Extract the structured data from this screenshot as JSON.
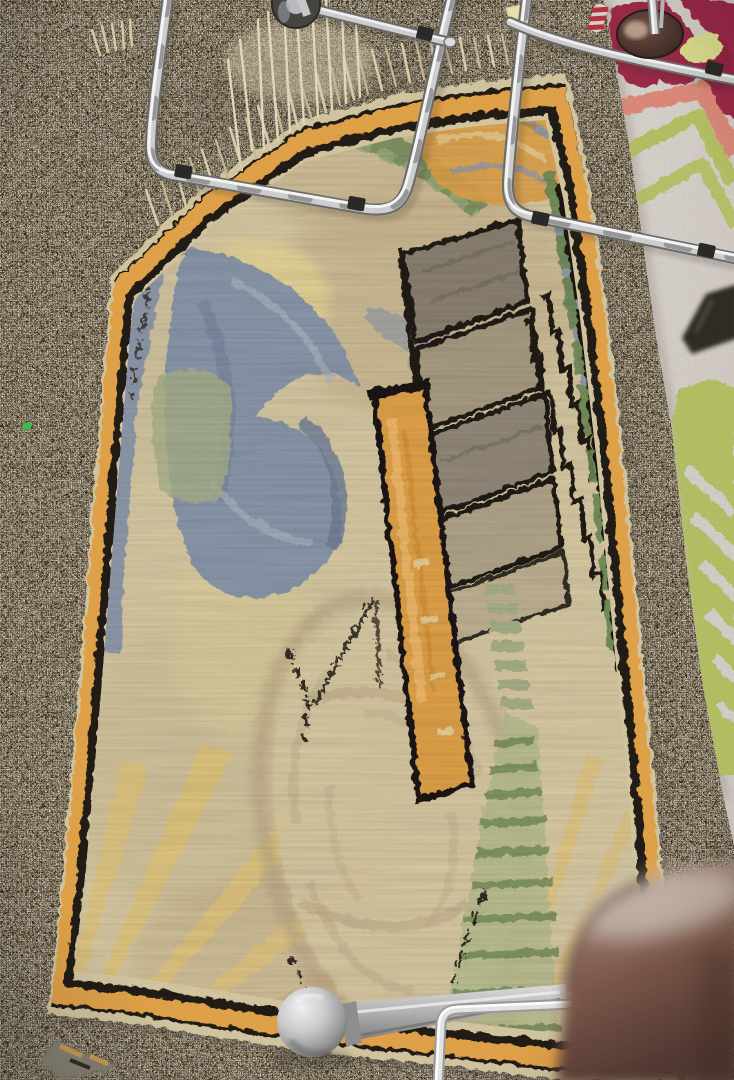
{
  "scene": {
    "type": "photograph",
    "subject": "art-deco-hooked-rug-on-showroom-floor",
    "objects": [
      {
        "name": "gray-carpet",
        "description": "speckled gray broadloom carpet floor"
      },
      {
        "name": "art-deco-rug",
        "description": "cream hooked runner with orange and black border, abstract blue swirl, stepped blocks, orange bar, oval and yellow rays"
      },
      {
        "name": "floral-rug",
        "description": "ivory rug with crimson flower, salmon and chartreuse stripes and leaf"
      },
      {
        "name": "chrome-chair-frames",
        "description": "two tubular chrome chair frames lying across the rug"
      },
      {
        "name": "caster-wheel",
        "description": "dark caster wheel at top edge"
      },
      {
        "name": "stool-base",
        "description": "round dark metal base with chrome column"
      },
      {
        "name": "ball-caster",
        "description": "aluminum ball foot with tapered leg"
      },
      {
        "name": "wooden-chair-seat",
        "description": "blurred brown wooden chair edge, bottom right"
      },
      {
        "name": "black-chair-leg",
        "description": "black chair leg entering right edge"
      },
      {
        "name": "rug-fringe",
        "description": "pale fringe at top end of runner"
      }
    ]
  },
  "colors": {
    "carpet_base": "#8f897b",
    "rug_field": "#d7c9a3",
    "rug_orange": "#e0a24a",
    "rug_black": "#211c15",
    "rug_blue": "#8795ab",
    "rug_sage": "#a7b089",
    "rug_green_dark": "#6e8a55",
    "rug_yellow": "#e2c67a",
    "rug_tan_block": "#a89b82",
    "white_rug": "#d5cfc9",
    "flower_crimson": "#9c2b49",
    "flower_salmon": "#dc8a7a",
    "leaf_chartreuse": "#b5c065",
    "flower_center": "#dbde8f",
    "chrome_dark": "#6b6b6b",
    "chrome_mid": "#cfcfcf",
    "clip_black": "#2c2a27",
    "wood_brown": "#7e5a4c",
    "base_maroon": "#4a332c",
    "aluminum_ball": "#c9c9c9",
    "fleck_green": "#35c24b",
    "tag_yellow": "#e9e0ad"
  }
}
